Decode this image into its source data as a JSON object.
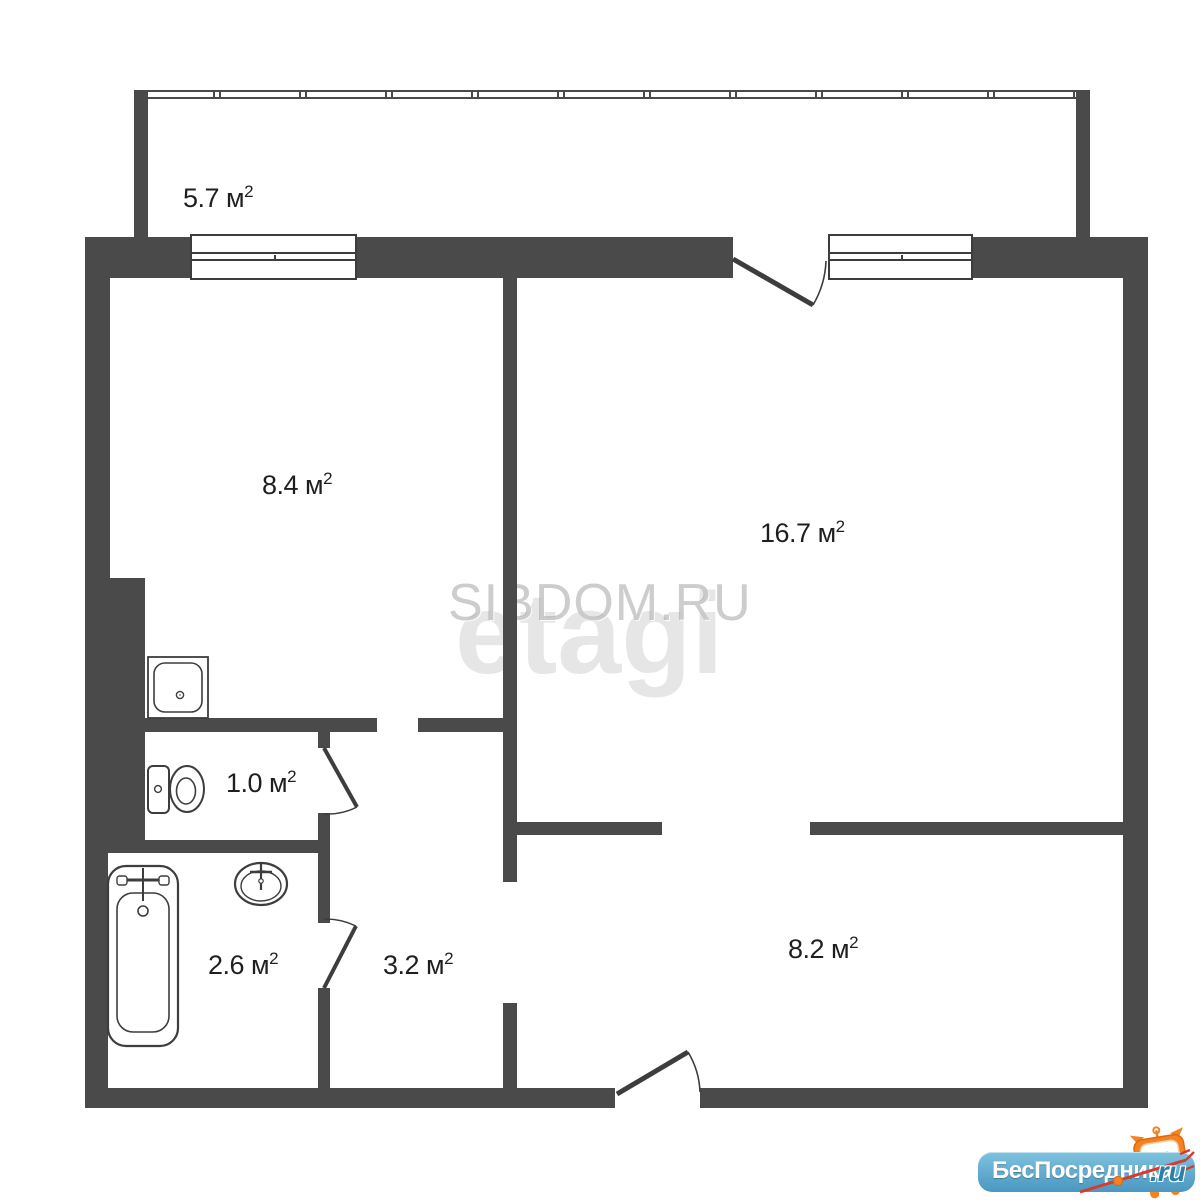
{
  "plan_title": "apartment-floor-plan",
  "rooms": {
    "balcony": {
      "area": "5.7",
      "unit": " м",
      "sup": "2"
    },
    "kitchen": {
      "area": "8.4",
      "unit": " м",
      "sup": "2"
    },
    "living": {
      "area": "16.7",
      "unit": " м",
      "sup": "2"
    },
    "toilet": {
      "area": "1.0",
      "unit": " м",
      "sup": "2"
    },
    "bathroom": {
      "area": "2.6",
      "unit": " м",
      "sup": "2"
    },
    "hallway": {
      "area": "3.2",
      "unit": " м",
      "sup": "2"
    },
    "entry": {
      "area": "8.2",
      "unit": " м",
      "sup": "2"
    }
  },
  "watermarks": {
    "primary": "SIBDOM.RU",
    "secondary": "etagi"
  },
  "logo": {
    "brand": "БесПосредника",
    "tld": ".ru"
  },
  "icons": [
    "bathtub-icon",
    "washbasin-icon",
    "toilet-icon",
    "kitchen-sink-icon",
    "mascot-cat-icon",
    "trident-icon"
  ],
  "colors": {
    "wall": "#4a4a4b",
    "line": "#3d3d3e",
    "label_text": "#1f1f1f",
    "watermark_gray": "#bdbdbd",
    "logo_blue": "#4a97c0",
    "logo_blue_dark": "#2e7fa8",
    "mascot_orange": "#f58220",
    "trident_red": "#d93a2e",
    "background": "#ffffff"
  }
}
